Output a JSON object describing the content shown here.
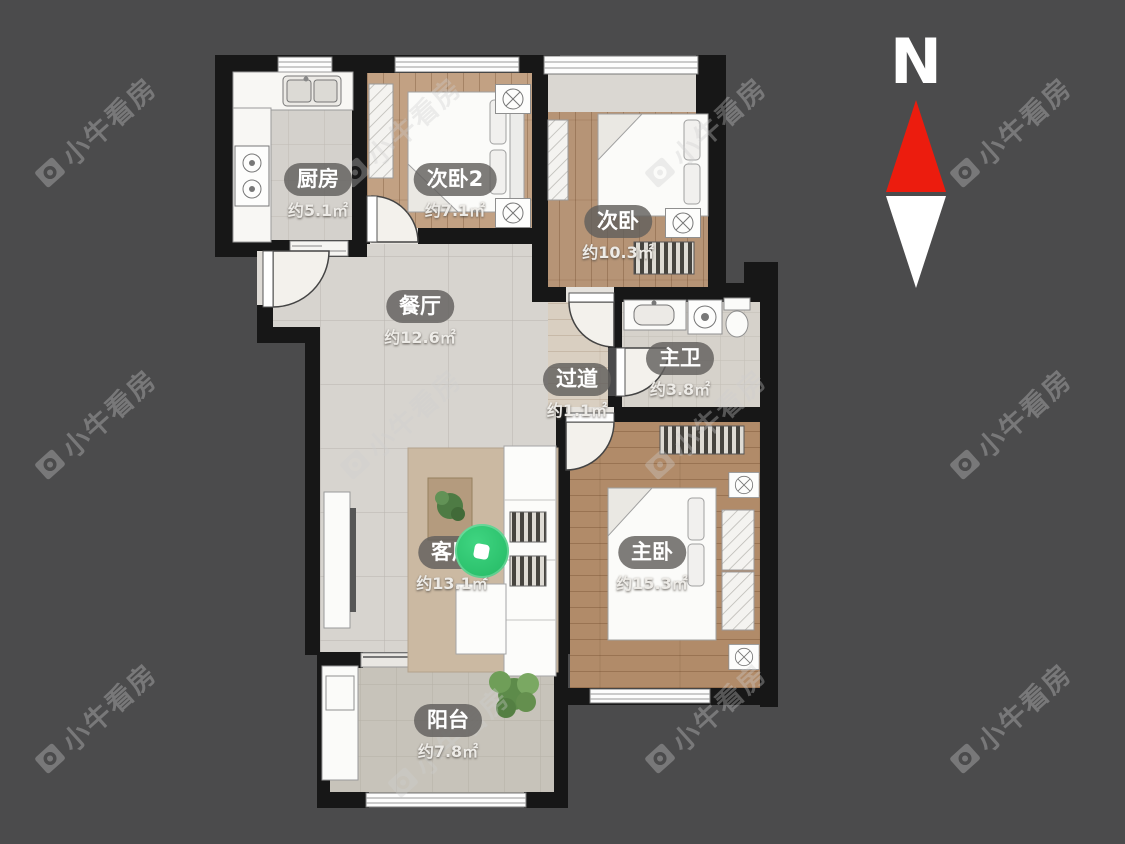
{
  "canvas": {
    "background": "#4b4b4c"
  },
  "compass": {
    "label": "N"
  },
  "watermark": {
    "text": "小牛看房"
  },
  "colors": {
    "wall": "#171717",
    "north_red": "#ec1c0e",
    "marker_green": "#2cc76f"
  },
  "rooms": [
    {
      "id": "kitchen",
      "name": "厨房",
      "area": "约5.1㎡"
    },
    {
      "id": "bedroom2",
      "name": "次卧2",
      "area": "约7.1㎡"
    },
    {
      "id": "bedroom",
      "name": "次卧",
      "area": "约10.3㎡"
    },
    {
      "id": "dining",
      "name": "餐厅",
      "area": "约12.6㎡"
    },
    {
      "id": "hallway",
      "name": "过道",
      "area": "约1.1㎡"
    },
    {
      "id": "master-bathroom",
      "name": "主卫",
      "area": "约3.8㎡"
    },
    {
      "id": "living",
      "name": "客厅",
      "area": "约13.1㎡"
    },
    {
      "id": "master-bedroom",
      "name": "主卧",
      "area": "约15.3㎡"
    },
    {
      "id": "balcony",
      "name": "阳台",
      "area": "约7.8㎡"
    }
  ]
}
